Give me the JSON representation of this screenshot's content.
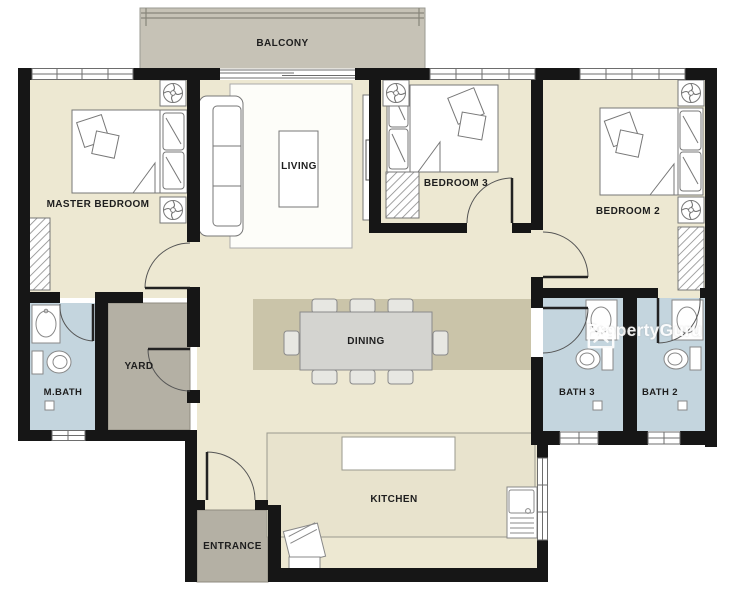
{
  "plan": {
    "type": "apartment-floor-plan",
    "rooms": {
      "balcony": {
        "label": "BALCONY"
      },
      "master_bedroom": {
        "label": "MASTER BEDROOM"
      },
      "living": {
        "label": "LIVING"
      },
      "bedroom3": {
        "label": "BEDROOM 3"
      },
      "bedroom2": {
        "label": "BEDROOM 2"
      },
      "master_bath": {
        "label": "M.BATH"
      },
      "yard": {
        "label": "YARD"
      },
      "dining": {
        "label": "DINING"
      },
      "bath3": {
        "label": "BATH 3"
      },
      "bath2": {
        "label": "BATH 2"
      },
      "kitchen": {
        "label": "KITCHEN"
      },
      "entrance": {
        "label": "ENTRANCE"
      }
    },
    "watermark": {
      "brand": "PropertyGuru",
      "icon": "propertyguru-house-chevron-icon"
    },
    "colors": {
      "floor": "#EDE8D2",
      "wall": "#161616",
      "bathroom_floor": "#C4D5DE",
      "service_floor": "#B4B0A4",
      "balcony_floor": "#C6C2B6",
      "dining_rug": "#CAC4A9",
      "furniture_line": "#777777",
      "watermark_text": "#FFFFFF"
    },
    "furniture_icons": [
      "double-bed",
      "pillows",
      "wardrobe-hatch",
      "ceiling-fan-icon",
      "sofa",
      "coffee-table",
      "tv-console",
      "rug",
      "dining-table",
      "dining-chair",
      "kitchen-counter",
      "kitchen-island",
      "kitchen-sink",
      "stove",
      "bathroom-basin",
      "toilet",
      "floor-trap",
      "door-swing",
      "window",
      "balcony-railing"
    ]
  }
}
